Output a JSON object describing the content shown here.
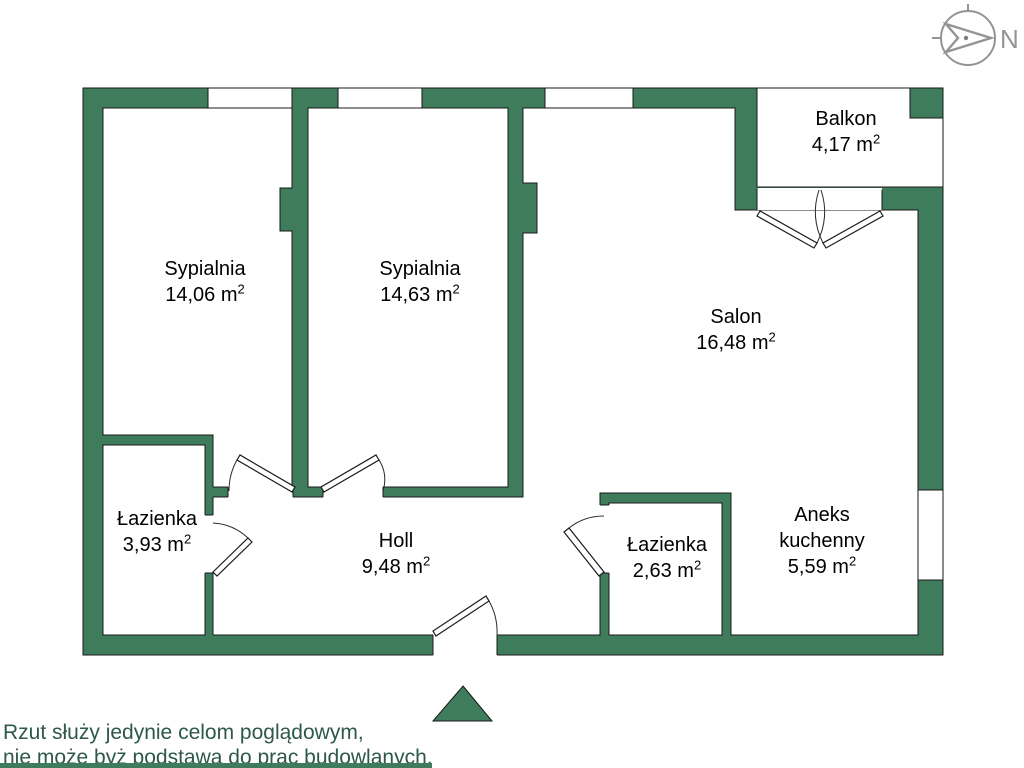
{
  "compass": {
    "label": "N"
  },
  "rooms": [
    {
      "id": "bedroom-1",
      "name": "Sypialnia",
      "area": "14,06 m",
      "sup": "2"
    },
    {
      "id": "bedroom-2",
      "name": "Sypialnia",
      "area": "14,63 m",
      "sup": "2"
    },
    {
      "id": "salon",
      "name": "Salon",
      "area": "16,48 m",
      "sup": "2"
    },
    {
      "id": "balcony",
      "name": "Balkon",
      "area": "4,17 m",
      "sup": "2"
    },
    {
      "id": "bathroom-1",
      "name": "Łazienka",
      "area": "3,93 m",
      "sup": "2"
    },
    {
      "id": "hall",
      "name": "Holl",
      "area": "9,48 m",
      "sup": "2"
    },
    {
      "id": "bathroom-2",
      "name": "Łazienka",
      "area": "2,63 m",
      "sup": "2"
    },
    {
      "id": "kitchen",
      "name_line1": "Aneks",
      "name_line2": "kuchenny",
      "area": "5,59 m",
      "sup": "2"
    }
  ],
  "disclaimer": {
    "line1": "Rzut służy jedynie celom poglądowym,",
    "line2": "nie może byż podstawą do prac budowlanych."
  },
  "colors": {
    "wall_green": "#3e7c5b",
    "outline_black": "#1a1a1a",
    "disclaimer_green": "#2e594a",
    "compass_gray": "#949494"
  }
}
